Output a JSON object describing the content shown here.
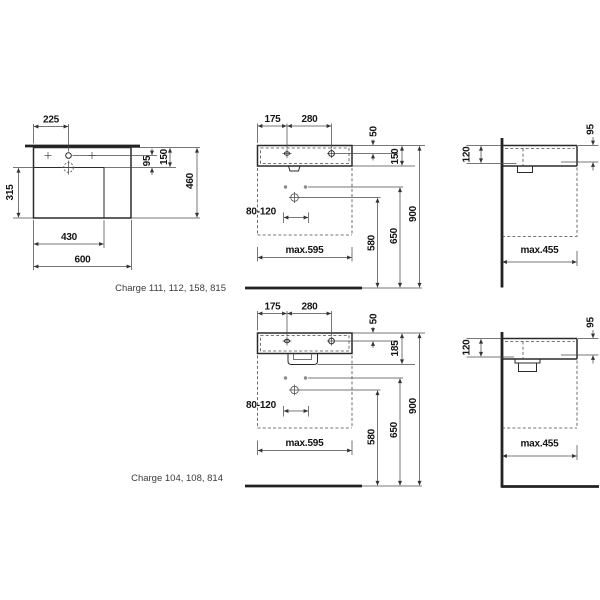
{
  "captions": {
    "variant_a": "Charge 111, 112, 158, 815",
    "variant_b": "Charge 104, 108, 814"
  },
  "plan_view": {
    "tap_offset": "225",
    "tap_to_drain": "95",
    "rim_to_drain": "150",
    "depth": "460",
    "bowl_depth": "315",
    "bowl_width": "430",
    "width": "600"
  },
  "front_view_a": {
    "edge_to_tap": "175",
    "tap_spacing": "280",
    "rim_to_tap": "50",
    "body_height": "150",
    "drain_offset_range": "80-120",
    "max_cabinet_width": "max.595",
    "drain_height": "580",
    "holes_height": "650",
    "rim_height": "900"
  },
  "front_view_b": {
    "edge_to_tap": "175",
    "tap_spacing": "280",
    "rim_to_tap": "50",
    "body_height": "185",
    "drain_offset_range": "80-120",
    "max_cabinet_width": "max.595",
    "drain_height": "580",
    "holes_height": "650",
    "rim_height": "900"
  },
  "side_view_a": {
    "ledge_depth": "120",
    "rim_thickness": "95",
    "max_cabinet_depth": "max.455"
  },
  "side_view_b": {
    "ledge_depth": "120",
    "rim_thickness": "95",
    "max_cabinet_depth": "max.455"
  }
}
